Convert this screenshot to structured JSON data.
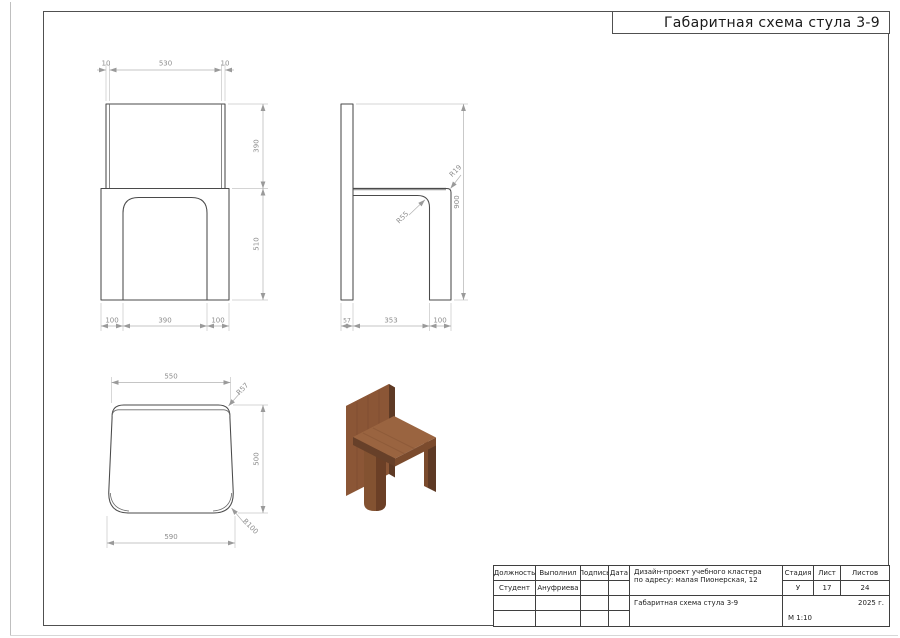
{
  "sheet": {
    "title": "Габаритная схема стула 3-9"
  },
  "views": {
    "front": {
      "dim_panel_thickness_left": "10",
      "dim_panel_width": "530",
      "dim_panel_thickness_right": "10",
      "dim_backrest_height": "390",
      "dim_seat_height": "510",
      "dim_leg_width_left": "100",
      "dim_opening_width": "390",
      "dim_leg_width_right": "100"
    },
    "side": {
      "dim_inner_radius": "R55",
      "dim_outer_radius": "R19",
      "dim_total_height": "900",
      "dim_back_thickness": "57",
      "dim_span": "353",
      "dim_leg_depth": "100"
    },
    "top": {
      "dim_back_width": "550",
      "dim_back_corner_radius": "R57",
      "dim_seat_depth": "500",
      "dim_front_width": "590",
      "dim_front_corner_radius": "R100"
    }
  },
  "title_block": {
    "header_position": "Должность",
    "header_executor": "Выполнил",
    "header_signature": "Подпись",
    "header_date": "Дата",
    "row_position": "Студент",
    "row_executor": "Ануфриева",
    "project_line1": "Дизайн-проект учебного кластера",
    "project_line2": "по адресу: малая Пионерская, 12",
    "doc_title": "Габаритная схема стула 3-9",
    "header_stage": "Стадия",
    "header_sheet": "Лист",
    "header_sheets": "Листов",
    "stage": "У",
    "sheet": "17",
    "sheets": "24",
    "year": "2025 г.",
    "scale": "М 1:10"
  },
  "render_3d": {
    "wood_top": "#a97352",
    "wood_front": "#8b5636",
    "wood_side_dark": "#5e3a25",
    "wood_seat": "#9a6440",
    "wood_edge": "#7b4b2d",
    "wood_edge_dark": "#674029",
    "wood_leg": "#835231",
    "wood_leg_shade": "#6b3f26"
  },
  "line_colors": {
    "outline": "#4a4a4a",
    "dimension": "#b2b2b2",
    "dim_text": "#8d8d8d"
  }
}
